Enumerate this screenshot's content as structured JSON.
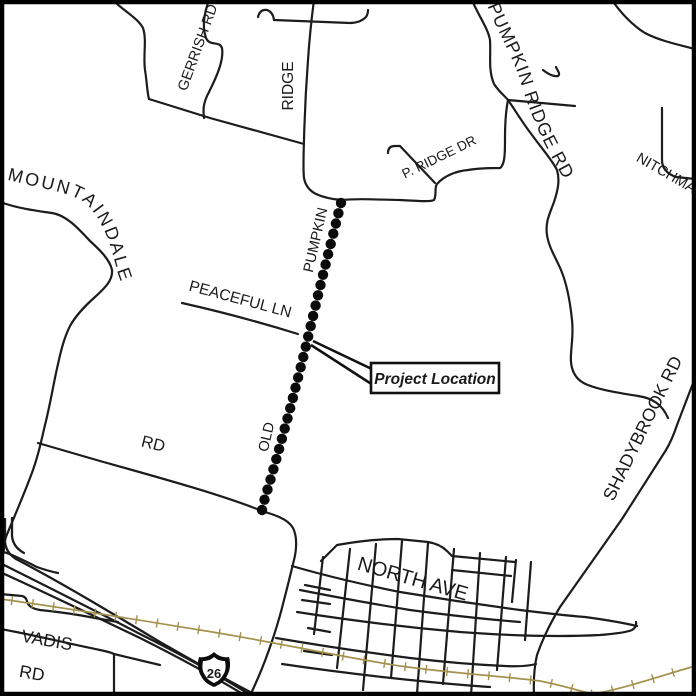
{
  "map": {
    "kind": "project-vicinity-road-map",
    "background_color": "#ffffff",
    "road_color": "#1c1c1c",
    "railroad_color": "#a5914e",
    "project_line_color": "#0b0b0b",
    "labels": {
      "gerrish_rd": "GERRISH RD",
      "ridge": "RIDGE",
      "pumpkin_ridge_rd": "PUMPKIN RIDGE RD",
      "nitchman": "NITCHMA",
      "p_ridge_dr": "P. RIDGE DR",
      "mountaindale": "MOUNTAINDALE",
      "peaceful_ln": "PEACEFUL LN",
      "pumpkin_vertical": "PUMPKIN",
      "old_vertical": "OLD",
      "rd_mid": "RD",
      "shadybrook_rd": "SHADYBROOK RD",
      "north_ave": "NORTH AVE",
      "vadis": "VADIS",
      "vadis_rd": "RD",
      "highway_shield_number": "26"
    },
    "callout": {
      "label": "Project Location"
    }
  }
}
